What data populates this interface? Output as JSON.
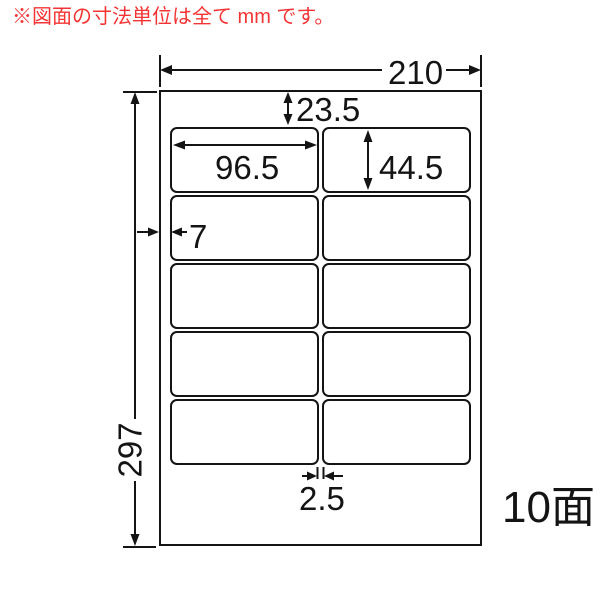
{
  "note": {
    "text": "※図面の寸法単位は全て mm です。",
    "color": "#f43434"
  },
  "diagram": {
    "line_color": "#141414",
    "paper_color": "#ffffff",
    "grid": {
      "columns": 2,
      "rows": 5
    },
    "dimensions_mm": {
      "sheet_width": "210",
      "sheet_height": "297",
      "top_margin": "23.5",
      "left_margin": "7",
      "label_width": "96.5",
      "label_height": "44.5",
      "column_gap": "2.5"
    },
    "faces_label": "10面"
  }
}
